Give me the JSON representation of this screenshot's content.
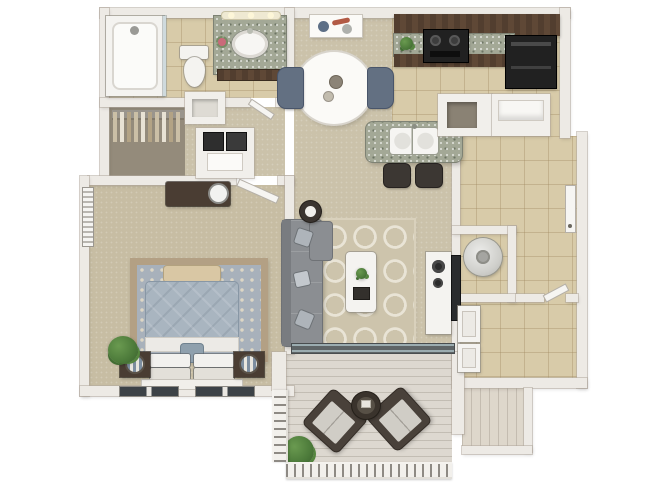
{
  "image": {
    "type": "3d-floor-plan-render",
    "description": "Top-down 3D rendering of a one-bedroom, one-bathroom apartment floor plan with attached patio",
    "background_color": "#ffffff",
    "visible_text": ""
  },
  "palette": {
    "wall": "#edeae5",
    "wall_edge": "#b2aa9e",
    "tile_floor": "#d8cba9",
    "carpet_floor": "#cbc2aa",
    "bedroom_carpet": "#c7bda3",
    "closet_carpet": "#948b7b",
    "deck_wood": "#ddd8d0",
    "dark_cabinet_wood": "#523e2f",
    "granite_counter": "#a3a896",
    "black_appliance": "#212121",
    "sofa_gray": "#8b8e92",
    "living_rug_base": "#cdc4ac",
    "living_rug_pattern": "#e9e4d6",
    "bedroom_rug_field": "#a8b1bb",
    "bedroom_rug_border": "#b3a084",
    "comforter_blue": "#a9b5c0",
    "linens_white": "#f4f3f0",
    "plant_green": "#4c7a3a",
    "dining_chair_blue": "#637082",
    "patio_chair_frame": "#49413a",
    "patio_cushion": "#d0cdc6",
    "water_heater": "#d4d4d1"
  },
  "rooms": {
    "bathroom": {
      "name": "Bathroom",
      "floor": "tile",
      "items": [
        "bathtub-shower-combo",
        "glass-shower-door",
        "shower-head",
        "toilet",
        "granite-vanity",
        "oval-sink",
        "vanity-lights",
        "flower-vase"
      ]
    },
    "walk_in_closet": {
      "name": "Walk-in closet",
      "floor": "carpet",
      "items": [
        "closet-rod",
        "hanging-clothes"
      ]
    },
    "linen_closet": {
      "name": "Linen closet",
      "floor": "carpet",
      "items": [
        "shelf"
      ]
    },
    "laundry_closet": {
      "name": "Washer/dryer closet",
      "floor": "carpet",
      "items": [
        "stacked-washer-dryer"
      ]
    },
    "bedroom": {
      "name": "Bedroom",
      "floor": "carpet",
      "items": [
        "dresser",
        "round-mirror",
        "oriental-area-rug",
        "foot-bench",
        "queen-bed",
        "blue-comforter",
        "white-pillows",
        "accent-pillow",
        "nightstand-left",
        "nightstand-right",
        "striped-lamp-left",
        "striped-lamp-right",
        "potted-plant",
        "window-blinds-left",
        "window-bottom-left",
        "window-bottom-right",
        "bedroom-door"
      ]
    },
    "dining_area": {
      "name": "Dining area",
      "floor": "carpet",
      "items": [
        "abstract-wall-art",
        "round-dining-table",
        "table-centerpiece",
        "dining-chair-left",
        "dining-chair-right"
      ]
    },
    "kitchen": {
      "name": "Kitchen",
      "floor": "tile",
      "items": [
        "upper-cabinets",
        "granite-countertop",
        "range-stove",
        "counter-plant",
        "refrigerator",
        "kitchen-island",
        "double-basin-sink",
        "bar-stool-1",
        "bar-stool-2",
        "pantry-closet",
        "shelf-closet"
      ]
    },
    "living_room": {
      "name": "Living room",
      "floor": "carpet",
      "items": [
        "sectional-sofa",
        "throw-pillows",
        "round-side-table",
        "trellis-rug",
        "coffee-table",
        "coffee-table-plant",
        "coffee-table-tray",
        "media-console",
        "flat-screen-tv",
        "sliding-glass-door"
      ]
    },
    "hallway": {
      "name": "Hallway",
      "floor": "tile",
      "items": [
        "entry-door"
      ]
    },
    "utility_closet": {
      "name": "Utility closet",
      "floor": "tile",
      "items": [
        "water-heater"
      ]
    },
    "laundry_room": {
      "name": "Laundry room",
      "floor": "tile",
      "items": [
        "cabinet-upper",
        "cabinet-lower",
        "laundry-door"
      ]
    },
    "patio": {
      "name": "Patio",
      "floor": "wood-deck",
      "items": [
        "lounge-chair-left",
        "lounge-chair-right",
        "round-patio-table",
        "patio-plant",
        "railing-bottom",
        "railing-left",
        "storage-closet"
      ]
    }
  }
}
